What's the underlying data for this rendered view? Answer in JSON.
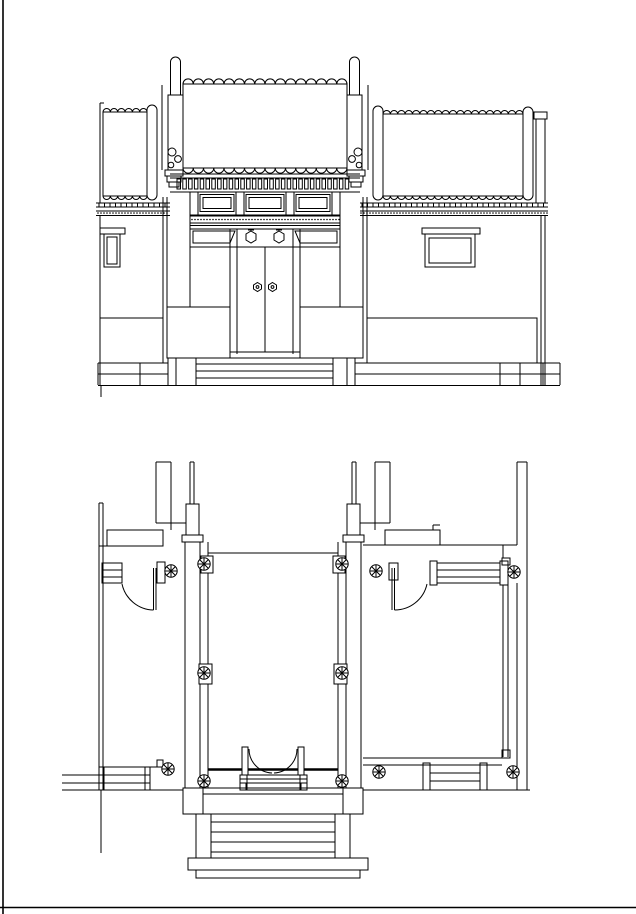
{
  "canvas": {
    "width": 636,
    "height": 914
  },
  "style": {
    "background": "#ffffff",
    "line": "#000000"
  },
  "drawing": {
    "kind": "architectural-cad-line-drawing",
    "views": [
      {
        "name": "gate-elevation"
      },
      {
        "name": "gate-plan"
      }
    ],
    "elevation": {
      "gate_roof": {
        "tile_columns": 16,
        "x0": 183,
        "tile_w": 10.25,
        "top": 84,
        "bottom": 168,
        "hump_r": 5.125
      },
      "left_roof": {
        "tile_columns": 6,
        "x0": 103,
        "tile_w": 7.35,
        "top": 112,
        "bottom": 196,
        "hump_r": 3.68
      },
      "right_roof": {
        "tile_columns": 19,
        "x0": 383,
        "tile_w": 7.37,
        "top": 114,
        "bottom": 196,
        "hump_r": 3.69
      },
      "dentils": {
        "count": 30,
        "x0": 177,
        "step": 5.8,
        "y": 179,
        "w": 3.5,
        "h": 10
      },
      "dot_band": {
        "x0": 192,
        "x1": 339,
        "y": 219.5,
        "step": 3
      },
      "eave_ticks_left": {
        "x0": 99,
        "x1": 167,
        "y": 203.5,
        "h": 3.4,
        "step": 5.5
      },
      "eave_ticks_right": {
        "x0": 362,
        "x1": 546,
        "y": 203.5,
        "h": 3.4,
        "step": 5.5
      },
      "eave_dots_left": {
        "x0": 98,
        "x1": 168,
        "y": 213,
        "step": 3
      },
      "eave_dots_right": {
        "x0": 361,
        "x1": 547,
        "y": 213,
        "step": 3
      },
      "door_pins": [
        [
          251,
          237
        ],
        [
          279,
          237
        ]
      ],
      "door_knockers": [
        [
          257.5,
          287
        ],
        [
          272.5,
          287
        ]
      ]
    },
    "plan": {
      "column_symbols": [
        [
          204,
          564
        ],
        [
          342,
          564
        ],
        [
          171,
          571
        ],
        [
          376,
          571
        ],
        [
          514,
          572
        ],
        [
          204,
          673
        ],
        [
          342,
          673
        ],
        [
          168,
          769
        ],
        [
          379,
          772
        ],
        [
          513,
          772
        ],
        [
          204,
          781
        ],
        [
          342,
          781
        ]
      ],
      "column_radius": 6.2
    }
  }
}
